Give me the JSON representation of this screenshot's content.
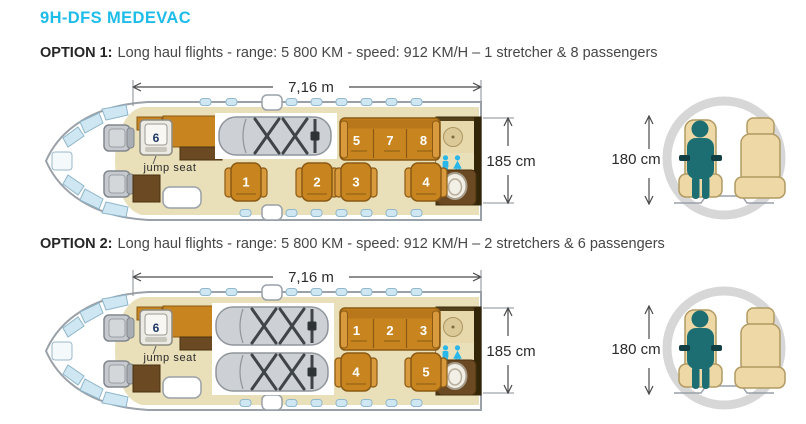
{
  "title": "9H-DFS MEDEVAC",
  "colors": {
    "accent_cyan": "#1ebde9",
    "seat_orange": "#c8851f",
    "cabin_tan": "#e9dfb9",
    "lavatory_brown": "#53401c",
    "stretcher_gray": "#cdd1d5",
    "restroom_icon_cyan": "#29b6e8",
    "person_teal": "#1c6e73"
  },
  "options": [
    {
      "name": "OPTION 1:",
      "description": "Long haul flights - range: 5 800 KM - speed: 912 KM/H – 1 stretcher & 8 passengers",
      "length": "7,16 m",
      "cabin_height": "185 cm",
      "cross_section_height": "180 cm",
      "stretcher_count": 1,
      "jump_seat": {
        "label": "jump seat",
        "number": "6"
      },
      "bench_seats": [
        "5",
        "7",
        "8"
      ],
      "chair_seats": [
        "1",
        "2",
        "3",
        "4"
      ]
    },
    {
      "name": "OPTION 2:",
      "description": "Long haul flights - range: 5 800 KM - speed: 912 KM/H – 2 stretchers & 6 passengers",
      "length": "7,16 m",
      "cabin_height": "185 cm",
      "cross_section_height": "180 cm",
      "stretcher_count": 2,
      "jump_seat": {
        "label": "jump seat",
        "number": "6"
      },
      "bench_seats": [
        "1",
        "2",
        "3"
      ],
      "chair_seats": [
        "4",
        "5"
      ]
    }
  ]
}
